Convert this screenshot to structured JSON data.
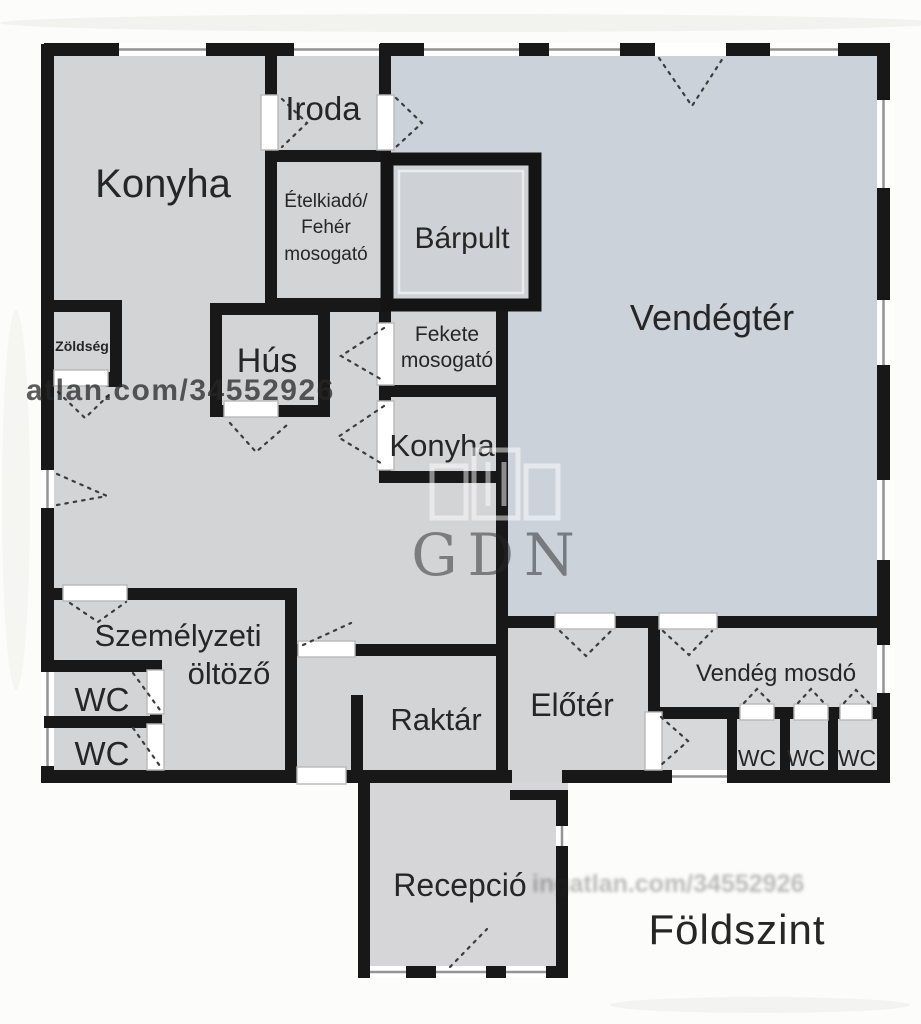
{
  "floor_title": "Földszint",
  "rooms": {
    "konyha_main": "Konyha",
    "iroda": "Iroda",
    "etelkiado_line1": "Ételkiadó/",
    "etelkiado_line2": "Fehér",
    "etelkiado_line3": "mosogató",
    "barpult": "Bárpult",
    "vendegter": "Vendégtér",
    "zoldseg": "Zöldség",
    "hus": "Hús",
    "fekete_line1": "Fekete",
    "fekete_line2": "mosogató",
    "konyha_small": "Konyha",
    "szemelyzeti_line1": "Személyzeti",
    "szemelyzeti_line2": "öltöző",
    "wc_staff_1": "WC",
    "wc_staff_2": "WC",
    "raktar": "Raktár",
    "eloter": "Előtér",
    "vendeg_mosdo": "Vendég mosdó",
    "wc_guest_1": "WC",
    "wc_guest_2": "WC",
    "wc_guest_3": "WC",
    "recepcio": "Recepció"
  },
  "watermarks": {
    "listing_url": "atlan.com/34552926",
    "brand": "GDN",
    "faint_url": "ingatlan.com/34552926"
  },
  "colors": {
    "wall": "#181818",
    "floor": "#d3d4d6",
    "guest_area": "#cbd2da",
    "washroom_area": "#d7d8da",
    "reception": "#d6d6d8"
  }
}
